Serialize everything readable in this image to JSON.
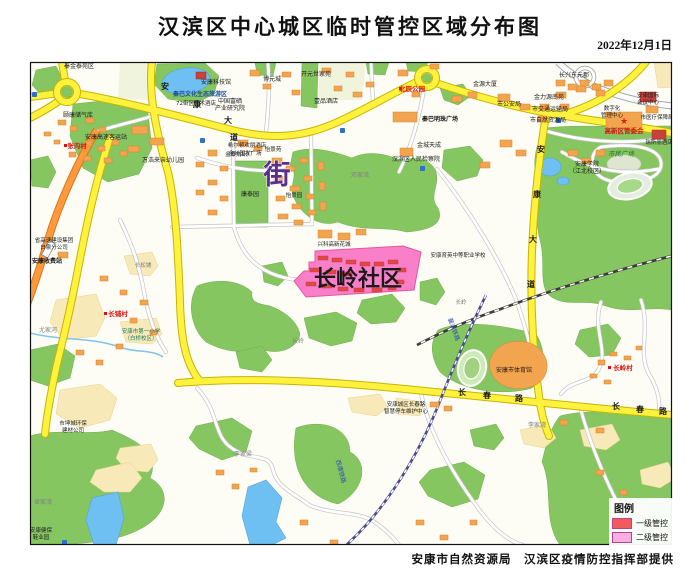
{
  "header": {
    "title": "汉滨区中心城区临时管控区域分布图",
    "date": "2022年12月1日"
  },
  "footer": {
    "credit": "安康市自然资源局　汉滨区疫情防控指挥部提供"
  },
  "legend": {
    "title": "图例",
    "items": [
      {
        "label": "一级管控",
        "color": "#f25b5b"
      },
      {
        "label": "二级管控",
        "color": "#f9aee3"
      }
    ]
  },
  "control_zone": {
    "name": "长岭社区"
  },
  "colors": {
    "road_major": "#fff23f",
    "road_casing": "#c8b400",
    "highway": "#ff9a3c",
    "park": "#85c661",
    "water": "#6fc0f2",
    "building": "#f2a44e",
    "zone_fill": "#f97fc9",
    "zone_border": "#e8559e",
    "zone_building": "#e14747"
  },
  "map": {
    "labels": [
      {
        "text": "秦金泰苑区",
        "x": 79,
        "y": 68,
        "size": 6
      },
      {
        "text": "安康科技馆",
        "x": 216,
        "y": 84,
        "size": 6
      },
      {
        "text": "秦巴文化生态旅游区",
        "x": 200,
        "y": 96,
        "size": 6,
        "color": "#1b4c9c",
        "bold": true
      },
      {
        "text": "72街区艺术酒店",
        "x": 196,
        "y": 105,
        "size": 5.5
      },
      {
        "text": "中国富硒",
        "x": 230,
        "y": 103,
        "size": 6
      },
      {
        "text": "产业研究院",
        "x": 230,
        "y": 110,
        "size": 6
      },
      {
        "text": "颐康储气库",
        "x": 78,
        "y": 117,
        "size": 6
      },
      {
        "text": "安康高速客运站",
        "x": 106,
        "y": 139,
        "size": 6
      },
      {
        "text": "张沟村",
        "x": 77,
        "y": 148,
        "size": 6.5,
        "color": "#e01010",
        "bold": true
      },
      {
        "text": "万浩来亲幼儿园",
        "x": 163,
        "y": 162,
        "size": 6
      },
      {
        "text": "金泰纺织厂",
        "x": 239,
        "y": 156,
        "size": 5.5
      },
      {
        "text": "博元城",
        "x": 272,
        "y": 81,
        "size": 6
      },
      {
        "text": "开元世家苑",
        "x": 316,
        "y": 76,
        "size": 6
      },
      {
        "text": "壹品酒店",
        "x": 326,
        "y": 103,
        "size": 6
      },
      {
        "text": "北辰公园",
        "x": 412,
        "y": 91,
        "size": 6.5,
        "color": "#e01010",
        "bold": true
      },
      {
        "text": "秦巴明珠广场",
        "x": 440,
        "y": 121,
        "size": 6,
        "bold": true
      },
      {
        "text": "金城天成",
        "x": 429,
        "y": 147,
        "size": 6
      },
      {
        "text": "汉滨区人民检察院",
        "x": 416,
        "y": 161,
        "size": 6
      },
      {
        "text": "邓家湾",
        "x": 360,
        "y": 177,
        "size": 6,
        "color": "#808080"
      },
      {
        "text": "希尔顿欢朋酒店",
        "x": 247,
        "y": 147,
        "size": 5.5
      },
      {
        "text": "金州国发广场",
        "x": 245,
        "y": 155,
        "size": 5.5
      },
      {
        "text": "怡景苑",
        "x": 273,
        "y": 151,
        "size": 5.5
      },
      {
        "text": "康泰园",
        "x": 250,
        "y": 196,
        "size": 6
      },
      {
        "text": "怡景园",
        "x": 294,
        "y": 197,
        "size": 5.5
      },
      {
        "text": "街",
        "x": 277,
        "y": 184,
        "size": 27,
        "color": "#5b2d8e",
        "bold": true,
        "stroke": "#ffffff"
      },
      {
        "text": "长兴东元郡",
        "x": 574,
        "y": 77,
        "size": 6
      },
      {
        "text": "金源大厦",
        "x": 485,
        "y": 86,
        "size": 6
      },
      {
        "text": "市公安局",
        "x": 509,
        "y": 106,
        "size": 6
      },
      {
        "text": "金力源南苑",
        "x": 549,
        "y": 99,
        "size": 6
      },
      {
        "text": "市交通运输局",
        "x": 550,
        "y": 111,
        "size": 6
      },
      {
        "text": "市自然资源局",
        "x": 548,
        "y": 122,
        "size": 6
      },
      {
        "text": "安康国际",
        "x": 648,
        "y": 97,
        "size": 5.5
      },
      {
        "text": "会议中心",
        "x": 648,
        "y": 104,
        "size": 5.5
      },
      {
        "text": "数字化",
        "x": 612,
        "y": 110,
        "size": 5.5
      },
      {
        "text": "管理中心",
        "x": 612,
        "y": 117,
        "size": 5.5
      },
      {
        "text": "市医疗保障局",
        "x": 657,
        "y": 119,
        "size": 5.5
      },
      {
        "text": "★",
        "x": 624,
        "y": 124,
        "size": 9,
        "color": "#e02020"
      },
      {
        "text": "高新区管委会",
        "x": 624,
        "y": 133,
        "size": 6.5,
        "color": "#e01010",
        "bold": true
      },
      {
        "text": "瑞斯丽酒店",
        "x": 659,
        "y": 144,
        "size": 5.5
      },
      {
        "text": "市民广场",
        "x": 621,
        "y": 156,
        "size": 6.5,
        "color": "#2c6e31",
        "italic": true
      },
      {
        "text": "安康学院",
        "x": 587,
        "y": 166,
        "size": 6
      },
      {
        "text": "（江北校区）",
        "x": 587,
        "y": 173,
        "size": 6
      },
      {
        "text": "安康育英中等职业学校",
        "x": 458,
        "y": 257,
        "size": 5.5
      },
      {
        "text": "兴科高新花城",
        "x": 334,
        "y": 246,
        "size": 5.5
      },
      {
        "text": "长岭社区",
        "x": 358,
        "y": 286,
        "size": 22,
        "bold": true
      },
      {
        "text": "长岭",
        "x": 461,
        "y": 304,
        "size": 5.5,
        "color": "#808080"
      },
      {
        "text": "长岭",
        "x": 298,
        "y": 343,
        "size": 6,
        "color": "#808080"
      },
      {
        "text": "安康市体育馆",
        "x": 514,
        "y": 372,
        "size": 6
      },
      {
        "text": "安康城区长春路",
        "x": 406,
        "y": 406,
        "size": 5.5
      },
      {
        "text": "智慧停车维护中心",
        "x": 406,
        "y": 413,
        "size": 5.5
      },
      {
        "text": "李家湾",
        "x": 537,
        "y": 427,
        "size": 6,
        "color": "#808080"
      },
      {
        "text": "李家梁",
        "x": 243,
        "y": 456,
        "size": 6,
        "color": "#808080"
      },
      {
        "text": "尤家河",
        "x": 48,
        "y": 332,
        "size": 6,
        "color": "#808080"
      },
      {
        "text": "长松铺",
        "x": 143,
        "y": 267,
        "size": 5.5,
        "color": "#808080"
      },
      {
        "text": "长铺村",
        "x": 118,
        "y": 316,
        "size": 6.5,
        "color": "#e01010",
        "bold": true
      },
      {
        "text": "安康市第一小学",
        "x": 141,
        "y": 333,
        "size": 5.5,
        "color": "#1b7a5e"
      },
      {
        "text": "（白桥校区）",
        "x": 141,
        "y": 340,
        "size": 5.5,
        "color": "#1b7a5e"
      },
      {
        "text": "省高速建设集团",
        "x": 54,
        "y": 242,
        "size": 5.5
      },
      {
        "text": "白泉分公司",
        "x": 54,
        "y": 249,
        "size": 5.5
      },
      {
        "text": "安康收费站",
        "x": 47,
        "y": 263,
        "size": 6,
        "bold": true
      },
      {
        "text": "市坤城环保",
        "x": 73,
        "y": 425,
        "size": 5.5
      },
      {
        "text": "建材公司",
        "x": 73,
        "y": 432,
        "size": 5.5
      },
      {
        "text": "卓家湾",
        "x": 43,
        "y": 504,
        "size": 6,
        "color": "#808080"
      },
      {
        "text": "安康健保",
        "x": 41,
        "y": 532,
        "size": 5.5
      },
      {
        "text": "鞋业园",
        "x": 41,
        "y": 539,
        "size": 5.5
      },
      {
        "text": "长岭村",
        "x": 623,
        "y": 370,
        "size": 6.5,
        "color": "#e01010",
        "bold": true
      },
      {
        "text": "襄渝铁路",
        "x": 452,
        "y": 330,
        "size": 6,
        "color": "#2b50b0",
        "rotate": 70
      },
      {
        "text": "西康铁路",
        "x": 339,
        "y": 472,
        "size": 6,
        "color": "#2b50b0",
        "rotate": 75
      },
      {
        "text": "安",
        "x": 165,
        "y": 89,
        "size": 8,
        "bold": true
      },
      {
        "text": "康",
        "x": 197,
        "y": 107,
        "size": 8,
        "bold": true
      },
      {
        "text": "大",
        "x": 228,
        "y": 123,
        "size": 8,
        "bold": true
      },
      {
        "text": "道",
        "x": 234,
        "y": 140,
        "size": 8,
        "bold": true
      },
      {
        "text": "安",
        "x": 541,
        "y": 152,
        "size": 8,
        "bold": true
      },
      {
        "text": "康",
        "x": 537,
        "y": 197,
        "size": 8,
        "bold": true
      },
      {
        "text": "大",
        "x": 533,
        "y": 242,
        "size": 8,
        "bold": true
      },
      {
        "text": "道",
        "x": 531,
        "y": 287,
        "size": 8,
        "bold": true
      },
      {
        "text": "长",
        "x": 462,
        "y": 395,
        "size": 8,
        "bold": true
      },
      {
        "text": "春",
        "x": 487,
        "y": 398,
        "size": 8,
        "bold": true
      },
      {
        "text": "路",
        "x": 519,
        "y": 401,
        "size": 8,
        "bold": true
      },
      {
        "text": "长",
        "x": 616,
        "y": 409,
        "size": 8,
        "bold": true
      },
      {
        "text": "春",
        "x": 640,
        "y": 412,
        "size": 8,
        "bold": true
      },
      {
        "text": "路",
        "x": 663,
        "y": 414,
        "size": 8,
        "bold": true
      }
    ]
  }
}
